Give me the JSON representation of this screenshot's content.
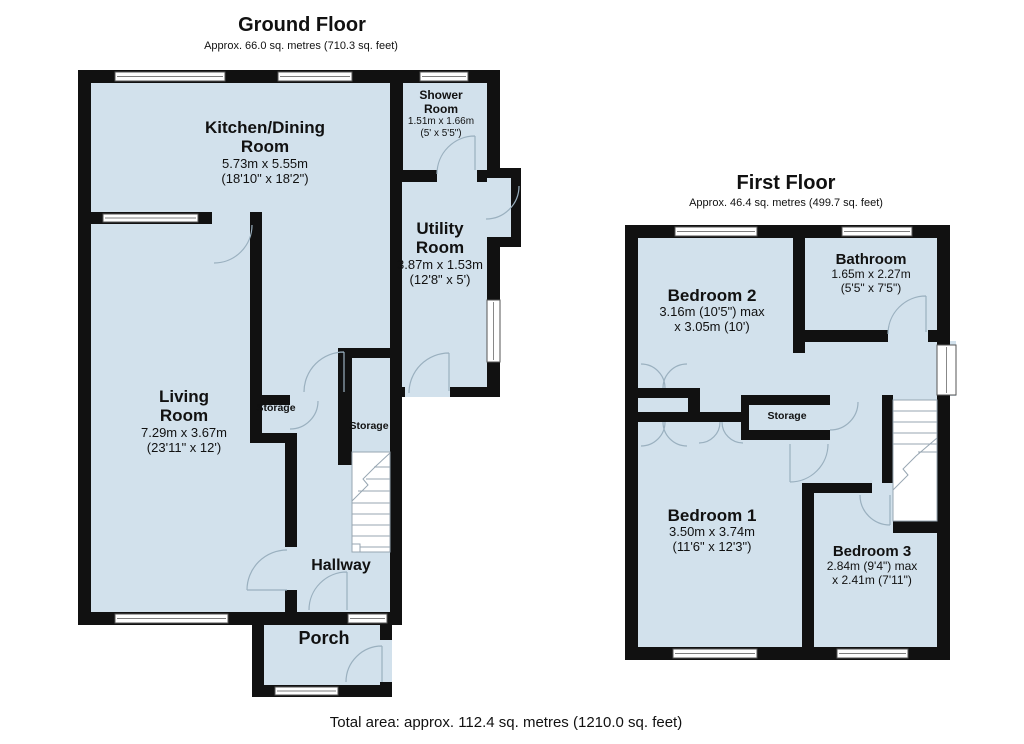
{
  "colors": {
    "room_fill": "#d2e1ec",
    "wall": "#111111",
    "door_arc": "#9ab0bf",
    "window_frame": "#555555"
  },
  "ground_floor": {
    "title": "Ground Floor",
    "subtitle": "Approx. 66.0 sq. metres (710.3 sq. feet)",
    "rooms": {
      "kitchen_dining": {
        "name": [
          "Kitchen/Dining",
          "Room"
        ],
        "dims": [
          "5.73m x 5.55m",
          "(18'10\" x 18'2\")"
        ]
      },
      "shower_room": {
        "name": [
          "Shower",
          "Room"
        ],
        "dims": [
          "1.51m x 1.66m",
          "(5' x 5'5\")"
        ]
      },
      "utility_room": {
        "name": [
          "Utility",
          "Room"
        ],
        "dims": [
          "3.87m x 1.53m",
          "(12'8\" x 5')"
        ]
      },
      "living_room": {
        "name": [
          "Living",
          "Room"
        ],
        "dims": [
          "7.29m x 3.67m",
          "(23'11\" x 12')"
        ]
      },
      "storage_left": {
        "name": [
          "Storage"
        ]
      },
      "storage_right": {
        "name": [
          "Storage"
        ]
      },
      "hallway": {
        "name": [
          "Hallway"
        ]
      },
      "porch": {
        "name": [
          "Porch"
        ]
      }
    }
  },
  "first_floor": {
    "title": "First Floor",
    "subtitle": "Approx. 46.4 sq. metres (499.7 sq. feet)",
    "rooms": {
      "bedroom2": {
        "name": [
          "Bedroom 2"
        ],
        "dims": [
          "3.16m (10'5\") max",
          "x 3.05m (10')"
        ]
      },
      "bathroom": {
        "name": [
          "Bathroom"
        ],
        "dims": [
          "1.65m x 2.27m",
          "(5'5\" x 7'5\")"
        ]
      },
      "storage": {
        "name": [
          "Storage"
        ]
      },
      "bedroom1": {
        "name": [
          "Bedroom 1"
        ],
        "dims": [
          "3.50m x 3.74m",
          "(11'6\" x 12'3\")"
        ]
      },
      "bedroom3": {
        "name": [
          "Bedroom 3"
        ],
        "dims": [
          "2.84m (9'4\") max",
          "x 2.41m (7'11\")"
        ]
      }
    }
  },
  "footer": {
    "total_area": "Total area: approx. 112.4 sq. metres (1210.0 sq. feet)"
  }
}
